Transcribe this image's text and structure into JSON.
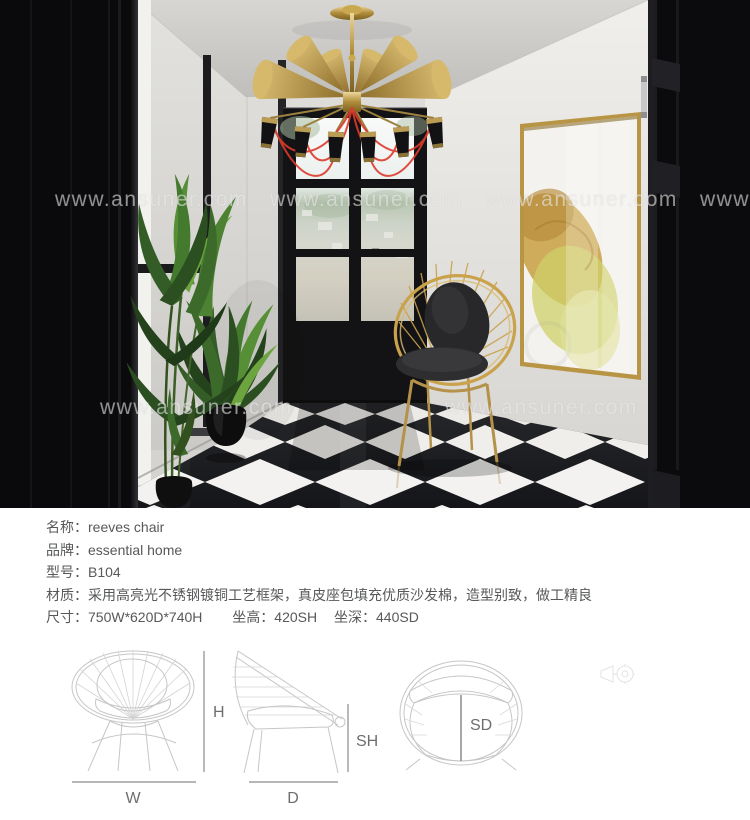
{
  "photo": {
    "watermark": "www.ansuner.com"
  },
  "specs": {
    "name": "名称：reeves chair",
    "brand": "品牌：essential home",
    "model": "型号：B104",
    "material": "材质：采用高亮光不锈钢镀铜工艺框架，真皮座包填充优质沙发棉，造型别致，做工精良",
    "size": "尺寸：750W*620D*740H",
    "seat_height": "坐高：420SH",
    "seat_depth": "坐深：440SD"
  },
  "diagram": {
    "width_label": "W",
    "height_label": "H",
    "depth_label": "D",
    "seat_height_label": "SH",
    "seat_depth_label": "SD",
    "icons": {
      "projection": "projection-view-icon"
    }
  },
  "colors": {
    "brass_gold": "#c9a24b",
    "wire_red": "#dd3a2c",
    "floor_dark": "#17181a",
    "floor_white": "#f3f2f0"
  }
}
